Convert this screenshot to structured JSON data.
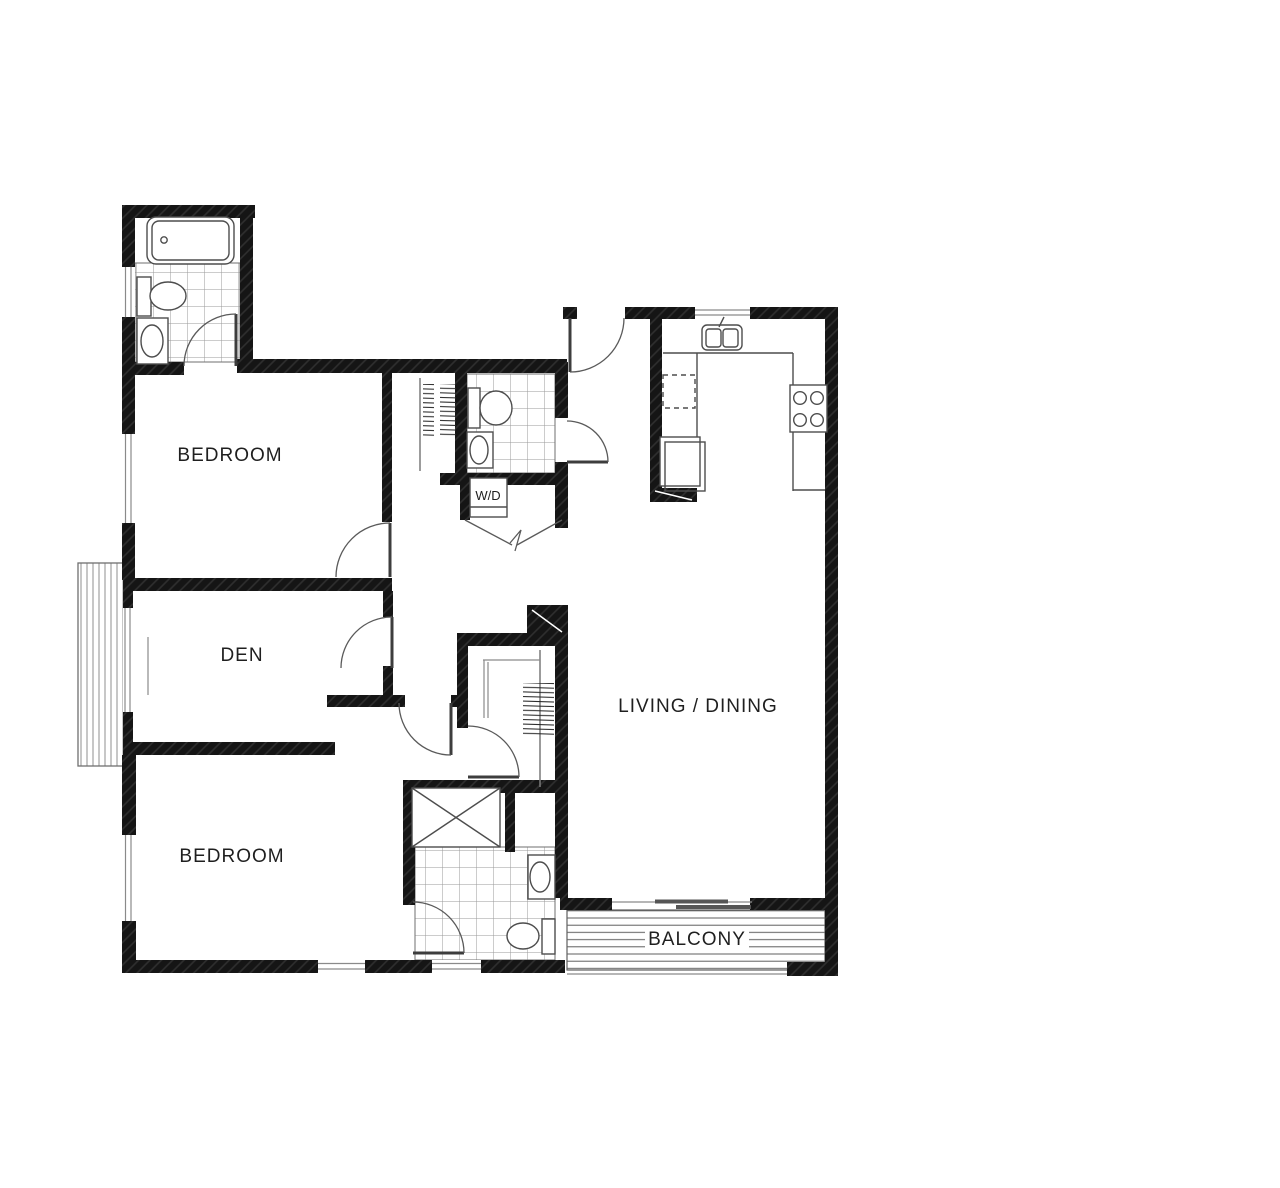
{
  "document": {
    "kind": "architectural-floor-plan",
    "background": "#ffffff"
  },
  "rooms": {
    "bedroom1": {
      "label": "BEDROOM"
    },
    "den": {
      "label": "DEN"
    },
    "bedroom2": {
      "label": "BEDROOM"
    },
    "living_dining": {
      "label": "LIVING / DINING"
    },
    "balcony": {
      "label": "BALCONY"
    },
    "laundry": {
      "label": "W/D"
    }
  },
  "unlabeled_areas": [
    "kitchen",
    "entry-hall",
    "bathroom-top-left",
    "bathroom-middle",
    "bathroom-ensuite",
    "walk-in-closet",
    "reach-in-closet",
    "bedroom2-nook"
  ],
  "fixtures": [
    "bathtub",
    "toilet",
    "vanity-sink",
    "shower-stall",
    "washer-dryer",
    "kitchen-sink",
    "range-cooktop",
    "refrigerator",
    "dishwasher",
    "closet-rod",
    "closet-shelf",
    "balcony-decking",
    "sliding-glass-door",
    "entry-door",
    "bifold-doors",
    "bay-window"
  ],
  "counts": {
    "bedrooms": 2,
    "bathrooms": 3,
    "doors_swing": 8,
    "windows": 7
  },
  "colors": {
    "background": "#ffffff",
    "walls": "#151515",
    "wall_hatch": "#2b2b2b",
    "linework": "#4d4d4d",
    "tile_grid": "#9a9a9a",
    "deck_lines": "#5f5f5f",
    "label_text": "#1f1f1f"
  }
}
